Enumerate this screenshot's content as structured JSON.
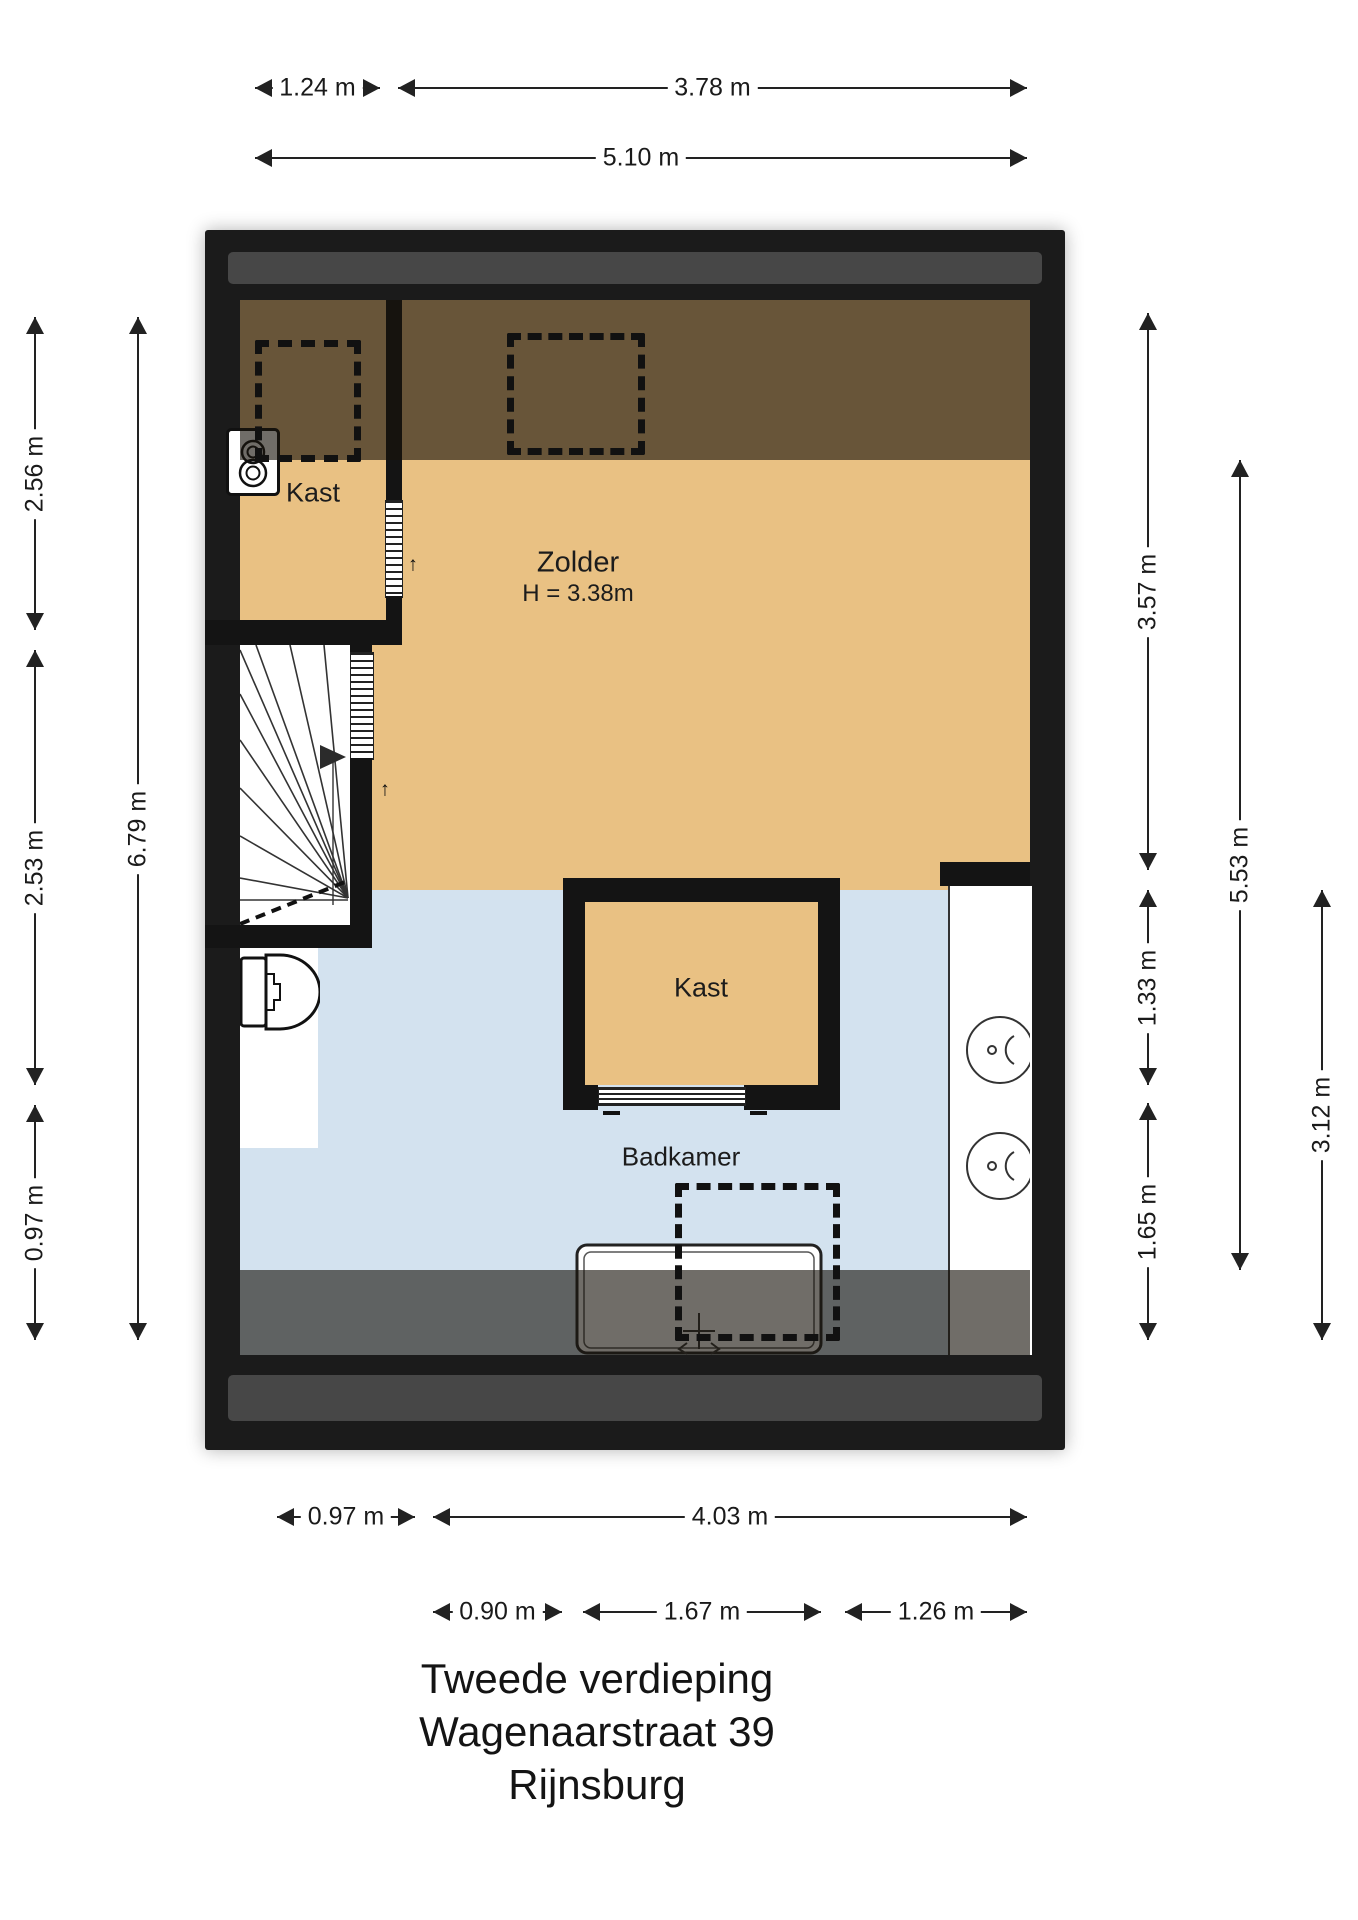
{
  "title": {
    "line1": "Tweede verdieping",
    "line2": "Wagenaarstraat 39",
    "line3": "Rijnsburg"
  },
  "rooms": {
    "kast_top_label": "Kast",
    "zolder_label": "Zolder",
    "zolder_height": "H = 3.38m",
    "kast_bathroom_label": "Kast",
    "badkamer_label": "Badkamer"
  },
  "icons": {
    "door_direction_arrow": "↑"
  },
  "colors": {
    "wall": "#1b1b1b",
    "roof_strip": "#474747",
    "attic_floor": "#e9c183",
    "bathroom_floor": "#d3e2ef",
    "low_headroom_overlay": "rgba(25,20,12,0.62)",
    "dimension_text": "#1a1a1a"
  },
  "dimensions": {
    "top": [
      {
        "label": "1.24 m",
        "y": 88,
        "x1": 255,
        "x2": 380
      },
      {
        "label": "3.78 m",
        "y": 88,
        "x1": 398,
        "x2": 1027
      },
      {
        "label": "5.10 m",
        "y": 158,
        "x1": 255,
        "x2": 1027
      }
    ],
    "bottom": [
      {
        "label": "0.97 m",
        "y": 1517,
        "x1": 277,
        "x2": 415
      },
      {
        "label": "4.03 m",
        "y": 1517,
        "x1": 433,
        "x2": 1027
      },
      {
        "label": "0.90 m",
        "y": 1612,
        "x1": 433,
        "x2": 562
      },
      {
        "label": "1.67 m",
        "y": 1612,
        "x1": 583,
        "x2": 821
      },
      {
        "label": "1.26 m",
        "y": 1612,
        "x1": 845,
        "x2": 1027
      }
    ],
    "left": [
      {
        "label": "2.56 m",
        "x": 35,
        "y1": 317,
        "y2": 630
      },
      {
        "label": "2.53 m",
        "x": 35,
        "y1": 650,
        "y2": 1085
      },
      {
        "label": "0.97 m",
        "x": 35,
        "y1": 1105,
        "y2": 1340
      },
      {
        "label": "6.79 m",
        "x": 138,
        "y1": 317,
        "y2": 1340
      }
    ],
    "right": [
      {
        "label": "3.57 m",
        "x": 1148,
        "y1": 313,
        "y2": 870
      },
      {
        "label": "1.33 m",
        "x": 1148,
        "y1": 890,
        "y2": 1085
      },
      {
        "label": "1.65 m",
        "x": 1148,
        "y1": 1103,
        "y2": 1340
      },
      {
        "label": "5.53 m",
        "x": 1240,
        "y1": 460,
        "y2": 1270
      },
      {
        "label": "3.12 m",
        "x": 1322,
        "y1": 890,
        "y2": 1340
      }
    ]
  }
}
